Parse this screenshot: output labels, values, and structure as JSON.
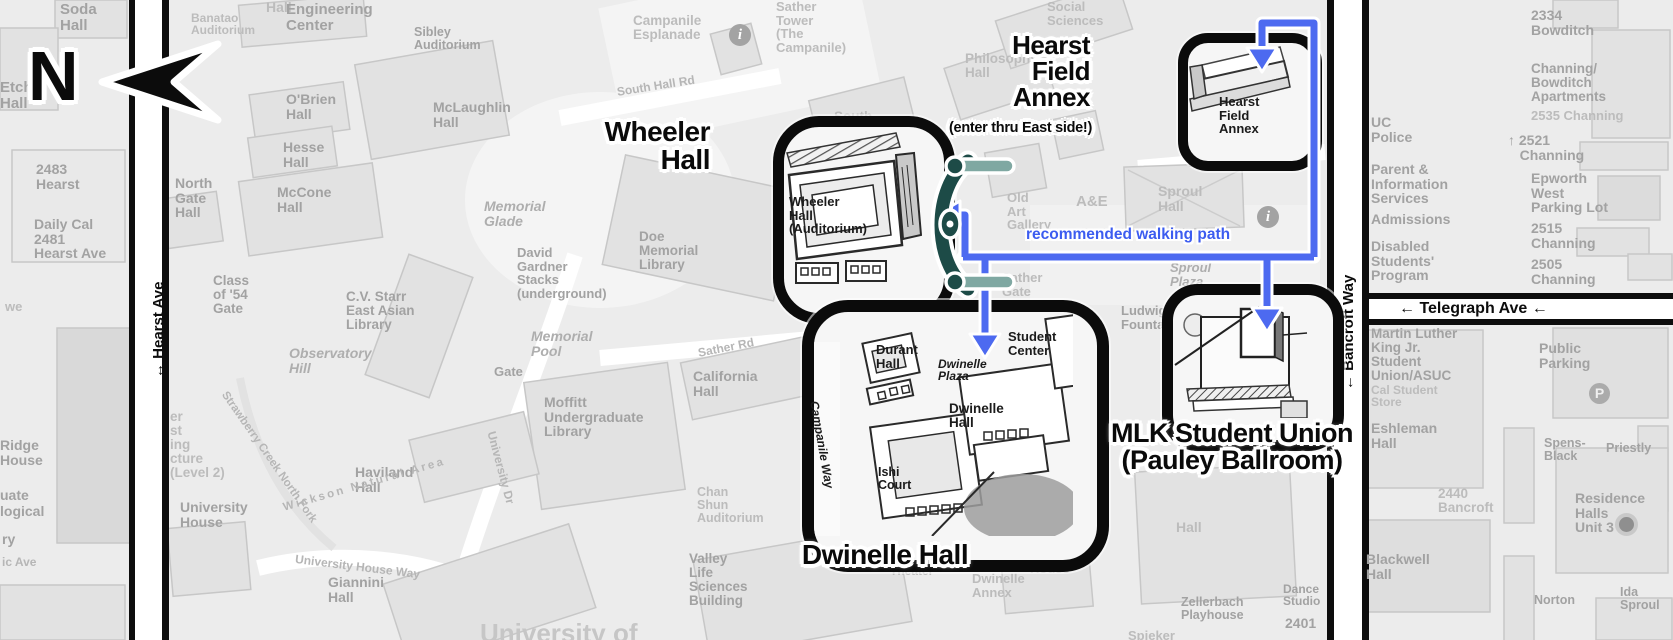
{
  "map": {
    "title": "UC Berkeley campus map with highlighted event buildings",
    "north": {
      "label": "N"
    },
    "path_label": "recommended walking path",
    "colors": {
      "path_blue": "#4d6af0",
      "gate_dark_teal": "#1d4b47",
      "gate_light_teal": "#7fa8a2",
      "callout_border": "#0b0b0b",
      "map_label_gray": "#a2a2a2"
    },
    "icons": {
      "info": "i",
      "parking": "P"
    },
    "streets": {
      "hearst": "↔ Hearst Ave",
      "bancroft": "← Bancroft Way",
      "telegraph": "← Telegraph Ave ←"
    },
    "callouts": [
      {
        "id": "wheeler",
        "title": "Wheeler\nHall",
        "building_label": "Wheeler Hall (Auditorium)"
      },
      {
        "id": "hearst-field-annex",
        "title": "Hearst\nField\nAnnex",
        "subtitle": "(enter thru East side!)",
        "building_label": "Hearst Field Annex"
      },
      {
        "id": "dwinelle",
        "title": "Dwinelle Hall",
        "building_label": "Dwinelle Hall"
      },
      {
        "id": "mlk",
        "title": "MLK Student Union\n(Pauley Ballroom)",
        "building_label": ""
      }
    ],
    "labels": [
      {
        "t": "Hall",
        "x": 266,
        "y": 0,
        "s": 14,
        "c": "gf"
      },
      {
        "t": "Soda\nHall",
        "x": 60,
        "y": 2,
        "s": 15,
        "c": "g"
      },
      {
        "t": "Etch\nHall",
        "x": 0,
        "y": 80,
        "s": 15,
        "c": "g"
      },
      {
        "t": "Banatao\nAuditorium",
        "x": 191,
        "y": 12,
        "s": 12,
        "c": "gf"
      },
      {
        "t": "Engineering\nCenter",
        "x": 286,
        "y": 2,
        "s": 15,
        "c": "g"
      },
      {
        "t": "Sibley\nAuditorium",
        "x": 414,
        "y": 26,
        "s": 12.5,
        "c": "g"
      },
      {
        "t": "Campanile\nEsplanade",
        "x": 633,
        "y": 14,
        "s": 13.5,
        "c": "gf"
      },
      {
        "t": "Sather\nTower\n(The\nCampanile)",
        "x": 776,
        "y": 0,
        "s": 13,
        "c": "gf"
      },
      {
        "t": "Social\nSciences",
        "x": 1047,
        "y": 0,
        "s": 13,
        "c": "gf"
      },
      {
        "t": "Philosophy\nHall",
        "x": 965,
        "y": 52,
        "s": 13.5,
        "c": "gf"
      },
      {
        "t": "O'Brien\nHall",
        "x": 286,
        "y": 92,
        "s": 14,
        "c": "g"
      },
      {
        "t": "McLaughlin\nHall",
        "x": 433,
        "y": 100,
        "s": 14,
        "c": "g"
      },
      {
        "t": "Hesse\nHall",
        "x": 283,
        "y": 140,
        "s": 14,
        "c": "g"
      },
      {
        "t": "McCone\nHall",
        "x": 277,
        "y": 185,
        "s": 14,
        "c": "g"
      },
      {
        "t": "North\nGate\nHall",
        "x": 175,
        "y": 176,
        "s": 14,
        "c": "g"
      },
      {
        "t": "2483\nHearst",
        "x": 36,
        "y": 162,
        "s": 14,
        "c": "g"
      },
      {
        "t": "Daily Cal\n2481\nHearst Ave",
        "x": 34,
        "y": 217,
        "s": 14,
        "c": "g"
      },
      {
        "t": "Class\nof '54\nGate",
        "x": 213,
        "y": 274,
        "s": 13.5,
        "c": "g"
      },
      {
        "t": "C.V. Starr\nEast Asian\nLibrary",
        "x": 346,
        "y": 290,
        "s": 13.5,
        "c": "g"
      },
      {
        "t": "Observatory\nHill",
        "x": 289,
        "y": 346,
        "s": 14,
        "c": "gi"
      },
      {
        "t": "Memorial\nGlade",
        "x": 484,
        "y": 199,
        "s": 14,
        "c": "gi"
      },
      {
        "t": "David\nGardner\nStacks\n(underground)",
        "x": 517,
        "y": 246,
        "s": 13,
        "c": "g"
      },
      {
        "t": "Doe\nMemorial\nLibrary",
        "x": 639,
        "y": 230,
        "s": 13.5,
        "c": "g"
      },
      {
        "t": "Memorial\nPool",
        "x": 531,
        "y": 329,
        "s": 14,
        "c": "gi"
      },
      {
        "t": "Gate",
        "x": 494,
        "y": 365,
        "s": 13,
        "c": "g"
      },
      {
        "t": "South Hall Rd",
        "x": 616,
        "y": 86,
        "s": 12,
        "c": "rd",
        "r": -9
      },
      {
        "t": "South",
        "x": 834,
        "y": 110,
        "s": 13.5,
        "c": "gf"
      },
      {
        "t": "Sather Rd",
        "x": 697,
        "y": 347,
        "s": 12,
        "c": "rd",
        "r": -11
      },
      {
        "t": "California\nHall",
        "x": 693,
        "y": 369,
        "s": 14,
        "c": "g"
      },
      {
        "t": "Moffitt\nUndergraduate\nLibrary",
        "x": 544,
        "y": 395,
        "s": 14,
        "c": "g"
      },
      {
        "t": "University Dr",
        "x": 497,
        "y": 430,
        "s": 12,
        "c": "rd",
        "r": 75
      },
      {
        "t": "Chan\nShun\nAuditorium",
        "x": 697,
        "y": 486,
        "s": 12.5,
        "c": "gf"
      },
      {
        "t": "Valley\nLife\nSciences\nBuilding",
        "x": 689,
        "y": 552,
        "s": 13.5,
        "c": "g"
      },
      {
        "t": "Haviland\nHall",
        "x": 355,
        "y": 465,
        "s": 14,
        "c": "g"
      },
      {
        "t": "University\nHouse",
        "x": 180,
        "y": 500,
        "s": 14,
        "c": "g"
      },
      {
        "t": "Giannini\nHall",
        "x": 328,
        "y": 575,
        "s": 14,
        "c": "g"
      },
      {
        "t": "University House Way",
        "x": 296,
        "y": 553,
        "s": 12,
        "c": "rd",
        "r": 7
      },
      {
        "t": "Strawberry Creek North Fork",
        "x": 228,
        "y": 390,
        "s": 11.5,
        "c": "rd",
        "r": 55
      },
      {
        "t": "Wickson Natural Area",
        "x": 282,
        "y": 503,
        "s": 11.5,
        "c": "rd",
        "r": -16,
        "ls": 2.5
      },
      {
        "t": "we",
        "x": 5,
        "y": 300,
        "s": 13,
        "c": "gf"
      },
      {
        "t": "Ridge\nHouse",
        "x": 0,
        "y": 438,
        "s": 14,
        "c": "g"
      },
      {
        "t": "uate",
        "x": 0,
        "y": 488,
        "s": 14,
        "c": "g"
      },
      {
        "t": "logical",
        "x": 0,
        "y": 504,
        "s": 14,
        "c": "g"
      },
      {
        "t": "ry",
        "x": 2,
        "y": 532,
        "s": 14,
        "c": "g"
      },
      {
        "t": "ic Ave",
        "x": 2,
        "y": 556,
        "s": 12,
        "c": "rd"
      },
      {
        "t": "er\nst\ning\ncture\n(Level 2)",
        "x": 170,
        "y": 410,
        "s": 13.5,
        "c": "gf"
      },
      {
        "t": "Barrow Lane",
        "x": 1188,
        "y": 157,
        "s": 12.5,
        "c": "rd"
      },
      {
        "t": "Old\nArt\nGallery",
        "x": 1007,
        "y": 191,
        "s": 13,
        "c": "gf"
      },
      {
        "t": "A&E",
        "x": 1076,
        "y": 194,
        "s": 15,
        "c": "gf"
      },
      {
        "t": "Sproul\nHall",
        "x": 1158,
        "y": 184,
        "s": 14,
        "c": "gf"
      },
      {
        "t": "Sproul\nPlaza",
        "x": 1170,
        "y": 261,
        "s": 13,
        "c": "gi"
      },
      {
        "t": "Sather\nGate",
        "x": 1002,
        "y": 271,
        "s": 13,
        "c": "gf"
      },
      {
        "t": "Chávez",
        "x": 1010,
        "y": 318,
        "s": 13,
        "c": "gf"
      },
      {
        "t": "Ludwig\nFountain",
        "x": 1121,
        "y": 304,
        "s": 13,
        "c": "g"
      },
      {
        "t": "Sproul",
        "x": 1221,
        "y": 430,
        "s": 15,
        "c": "gi"
      },
      {
        "t": "Studio\nTheater",
        "x": 890,
        "y": 553,
        "s": 12,
        "c": "gf"
      },
      {
        "t": "Dwinelle\nAnnex",
        "x": 972,
        "y": 572,
        "s": 13,
        "c": "gf"
      },
      {
        "t": "Alumni\nHouse",
        "x": 1030,
        "y": 548,
        "s": 13,
        "c": "gf"
      },
      {
        "t": "Hall",
        "x": 1176,
        "y": 520,
        "s": 14,
        "c": "gf"
      },
      {
        "t": "Zellerbach\nPlayhouse",
        "x": 1181,
        "y": 596,
        "s": 12.5,
        "c": "g"
      },
      {
        "t": "Dance\nStudio",
        "x": 1283,
        "y": 583,
        "s": 12,
        "c": "g"
      },
      {
        "t": "2401",
        "x": 1285,
        "y": 616,
        "s": 14,
        "c": "g"
      },
      {
        "t": "Spieker",
        "x": 1128,
        "y": 629,
        "s": 13,
        "c": "gf"
      },
      {
        "t": "University of",
        "x": 480,
        "y": 620,
        "s": 26,
        "c": "fade"
      },
      {
        "t": "2334\nBowditch",
        "x": 1531,
        "y": 8,
        "s": 14,
        "c": "g"
      },
      {
        "t": "Channing/\nBowditch\nApartments",
        "x": 1531,
        "y": 62,
        "s": 13.5,
        "c": "g"
      },
      {
        "t": "2535 Channing",
        "x": 1531,
        "y": 109,
        "s": 13,
        "c": "gf"
      },
      {
        "t": "UC\nPolice",
        "x": 1371,
        "y": 115,
        "s": 14,
        "c": "g"
      },
      {
        "t": "↑ 2521\n   Channing",
        "x": 1508,
        "y": 133,
        "s": 14,
        "c": "g"
      },
      {
        "t": "Parent &\nInformation\nServices",
        "x": 1371,
        "y": 162,
        "s": 14,
        "c": "g"
      },
      {
        "t": "Epworth\nWest\nParking Lot",
        "x": 1531,
        "y": 171,
        "s": 14,
        "c": "g"
      },
      {
        "t": "Admissions",
        "x": 1371,
        "y": 212,
        "s": 14,
        "c": "g"
      },
      {
        "t": "2515\nChanning",
        "x": 1531,
        "y": 221,
        "s": 14,
        "c": "g"
      },
      {
        "t": "Disabled\nStudents'\nProgram",
        "x": 1371,
        "y": 239,
        "s": 14,
        "c": "g"
      },
      {
        "t": "2505\nChanning",
        "x": 1531,
        "y": 257,
        "s": 14,
        "c": "g"
      },
      {
        "t": "Martin Luther\nKing Jr.\nStudent\nUnion/ASUC",
        "x": 1371,
        "y": 327,
        "s": 13.5,
        "c": "g"
      },
      {
        "t": "Cal Student\nStore",
        "x": 1371,
        "y": 384,
        "s": 12,
        "c": "gf"
      },
      {
        "t": "Public\nParking",
        "x": 1539,
        "y": 341,
        "s": 14,
        "c": "g"
      },
      {
        "t": "Eshleman\nHall",
        "x": 1371,
        "y": 421,
        "s": 14,
        "c": "g"
      },
      {
        "t": "Spens-\nBlack",
        "x": 1544,
        "y": 437,
        "s": 12.5,
        "c": "g"
      },
      {
        "t": "Priestly",
        "x": 1606,
        "y": 442,
        "s": 12.5,
        "c": "g"
      },
      {
        "t": "2440\nBancroft",
        "x": 1438,
        "y": 487,
        "s": 13.5,
        "c": "gf"
      },
      {
        "t": "Residence\nHalls\nUnit 3",
        "x": 1575,
        "y": 491,
        "s": 14,
        "c": "g"
      },
      {
        "t": "Blackwell\nHall",
        "x": 1366,
        "y": 552,
        "s": 14,
        "c": "g"
      },
      {
        "t": "Norton",
        "x": 1534,
        "y": 594,
        "s": 12.5,
        "c": "g"
      },
      {
        "t": "Ida\nSproul",
        "x": 1620,
        "y": 586,
        "s": 12.5,
        "c": "g"
      },
      {
        "t": "↔ Hearst Ave",
        "x": 151,
        "y": 378,
        "s": 15,
        "c": "st",
        "r": -90
      },
      {
        "t": "← Bancroft Way",
        "x": 1341,
        "y": 390,
        "s": 15,
        "c": "st",
        "r": -90
      },
      {
        "t": "← Telegraph Ave ←",
        "x": 1399,
        "y": 301,
        "s": 16,
        "c": "st"
      },
      {
        "t": "Wheeler\nHall\n(Auditorium)",
        "x": 789,
        "y": 195,
        "s": 13,
        "c": "dk"
      },
      {
        "t": "Hearst\nField\nAnnex",
        "x": 1219,
        "y": 95,
        "s": 13,
        "c": "dk"
      },
      {
        "t": "Durant\nHall",
        "x": 876,
        "y": 343,
        "s": 13,
        "c": "dk"
      },
      {
        "t": "Dwinelle\nPlaza",
        "x": 938,
        "y": 358,
        "s": 12,
        "c": "dki"
      },
      {
        "t": "Dwinelle\nHall",
        "x": 949,
        "y": 402,
        "s": 13.5,
        "c": "dk"
      },
      {
        "t": "Ishi\nCourt",
        "x": 878,
        "y": 466,
        "s": 12.5,
        "c": "dk"
      },
      {
        "t": "Student\nCenter",
        "x": 1008,
        "y": 330,
        "s": 13,
        "c": "dk"
      },
      {
        "t": "Campanile Way",
        "x": 820,
        "y": 400,
        "s": 12,
        "c": "dki",
        "r": 80
      }
    ]
  }
}
